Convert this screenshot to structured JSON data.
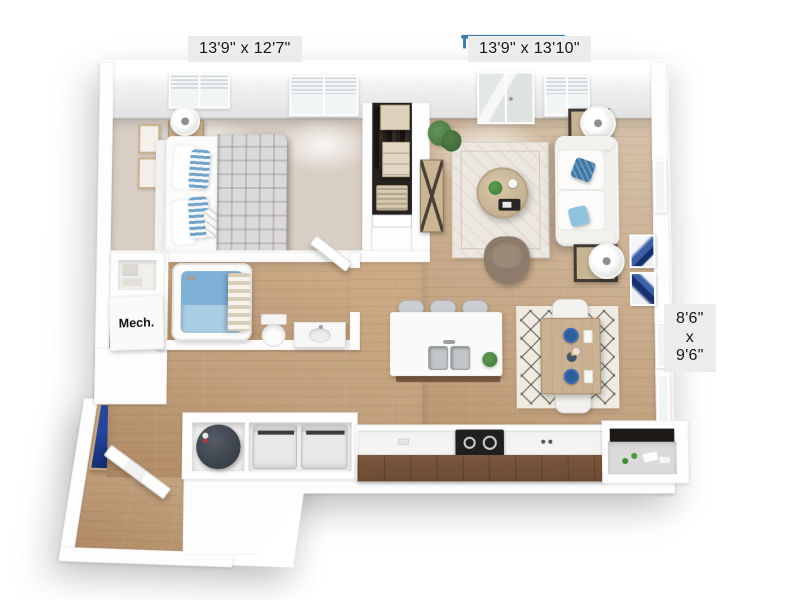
{
  "scene": {
    "description": "3D dollhouse-view apartment floor plan rendering on white background",
    "background": "#ffffff"
  },
  "labels": {
    "bedroom_dimensions": "13'9\" x 12'7\"",
    "living_room_dimensions": "13'9\" x 13'10\"",
    "balcony_dimensions": {
      "width": "8'6\"",
      "separator": "x",
      "depth": "9'6\""
    },
    "mechanical_room": "Mech."
  },
  "colors": {
    "label_bg": "#ececec",
    "label_text": "#161616",
    "carpet": "#d8cec3",
    "wood_light": "#d6c3ab",
    "wood_warm": "#c2a17e",
    "cabinet_dark": "#6b4b33",
    "railing_blue": "#3d7cab",
    "pillow_dark": "#3f77a6",
    "pillow_light": "#8fc2de",
    "stripe_blue": "#6fa3c9",
    "blanket": "#dadada",
    "rug_cream": "#ece8e1",
    "rug_dining": "#f0ebe1",
    "art_navy": "#1d3a8c",
    "art_blue": "#3b5fa8",
    "tub_blue": "#a9cde2",
    "water_blue": "#7fb0d6",
    "plate_blue": "#2e5d9e",
    "plant_green": "#4e7b44",
    "heater_dark": "#3a4049",
    "stove_black": "#1f1f1f",
    "island_base": "#7b5a40",
    "table_wood": "#c9b192",
    "nightstand_wood": "#c9ae8c",
    "armchair_brown": "#8d7b6c"
  },
  "rooms": [
    {
      "name": "bedroom",
      "floor": "carpet",
      "items": [
        "bed",
        "striped-pillows",
        "plaid-blanket",
        "nightstand",
        "table-lamp",
        "wall-frames",
        "windows",
        "reach-in-closet"
      ]
    },
    {
      "name": "living-room",
      "floor": "hardwood",
      "items": [
        "sofa",
        "throw-pillow-dark",
        "throw-pillow-light",
        "end-table",
        "table-lamp",
        "coffee-table",
        "area-rug",
        "armchair",
        "console-table",
        "potted-plant",
        "wall-art",
        "balcony-door"
      ]
    },
    {
      "name": "kitchen",
      "floor": "hardwood",
      "items": [
        "island",
        "double-sink",
        "bar-stool",
        "bar-stool",
        "bar-stool",
        "range-cooktop",
        "counter",
        "dark-cabinets",
        "pantry-nook"
      ]
    },
    {
      "name": "dining",
      "floor": "hardwood",
      "items": [
        "dining-table",
        "dining-chair",
        "dining-chair",
        "blue-plates",
        "patterned-rug"
      ]
    },
    {
      "name": "bathroom",
      "floor": "hardwood",
      "items": [
        "bathtub",
        "shower-curtain",
        "toilet",
        "vanity-sink",
        "door"
      ]
    },
    {
      "name": "utility",
      "items": [
        "washer",
        "dryer",
        "water-heater",
        "mech-closet",
        "linen-shelves"
      ]
    },
    {
      "name": "entry",
      "items": [
        "entry-door",
        "navy-wall-art"
      ]
    },
    {
      "name": "balcony",
      "items": [
        "railing"
      ]
    }
  ]
}
